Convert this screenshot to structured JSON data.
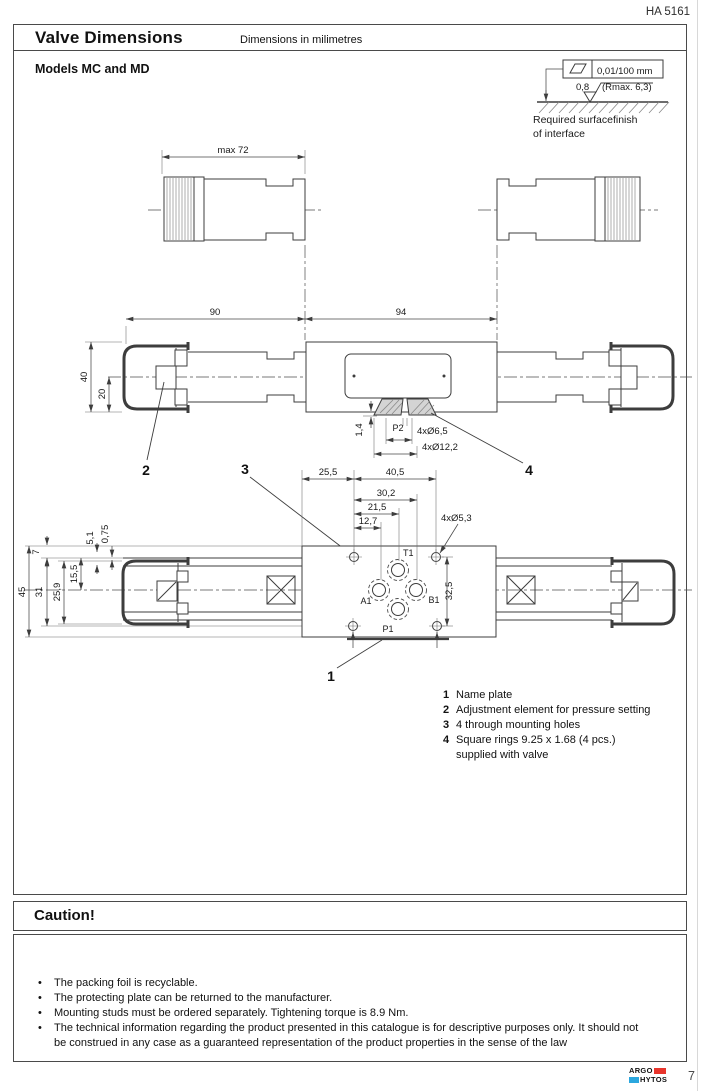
{
  "page": {
    "doc_code": "HA 5161",
    "page_number": "7"
  },
  "title_bar": {
    "title": "Valve Dimensions",
    "subtitle": "Dimensions in milimetres"
  },
  "models_label": "Models MC and MD",
  "surface_finish": {
    "flatness": "0,01/100 mm",
    "roughness": "0,8",
    "rmax": "(Rmax. 6,3)",
    "caption_line1": "Required surfacefinish",
    "caption_line2": "of interface"
  },
  "drawing": {
    "labels": {
      "max72": "max 72",
      "d90": "90",
      "d94": "94",
      "d40": "40",
      "d20": "20",
      "d1_4": "1,4",
      "p2": "P2",
      "d4xd65": "4xØ6,5",
      "d4xd122": "4xØ12,2",
      "d25_5": "25,5",
      "d40_5": "40,5",
      "d30_2": "30,2",
      "d21_5": "21,5",
      "d12_7": "12,7",
      "d4xd53": "4xØ5,3",
      "d32_5": "32,5",
      "d45": "45",
      "d31": "31",
      "d25_9": "25,9",
      "d15_5": "15,5",
      "d7": "7",
      "d5_1": "5,1",
      "d0_75": "0,75",
      "t1": "T1",
      "a1": "A1",
      "b1": "B1",
      "p1": "P1",
      "c1": "1",
      "c2": "2",
      "c3": "3",
      "c4": "4"
    }
  },
  "legend": {
    "items": [
      {
        "num": "1",
        "text": "Name plate"
      },
      {
        "num": "2",
        "text": "Adjustment element for pressure setting"
      },
      {
        "num": "3",
        "text": "4 through mounting holes"
      },
      {
        "num": "4",
        "text": "Square rings 9.25 x 1.68 (4 pcs.)",
        "text2": "supplied with valve"
      }
    ]
  },
  "caution": {
    "title": "Caution!",
    "bullets": [
      "The packing foil is recyclable.",
      "The protecting plate can be returned to the manufacturer.",
      "Mounting studs must be ordered separately. Tightening torque is 8.9 Nm.",
      "The technical information regarding the product presented in this catalogue is for descriptive purposes only. It should not be construed in any case as a guaranteed representation of the product properties in the sense of the law"
    ]
  },
  "footer": {
    "brand_top": "ARGO",
    "brand_bottom": "HYTOS",
    "brand_red": "#e8352c",
    "brand_blue": "#2ba7de",
    "page_number": "7"
  }
}
